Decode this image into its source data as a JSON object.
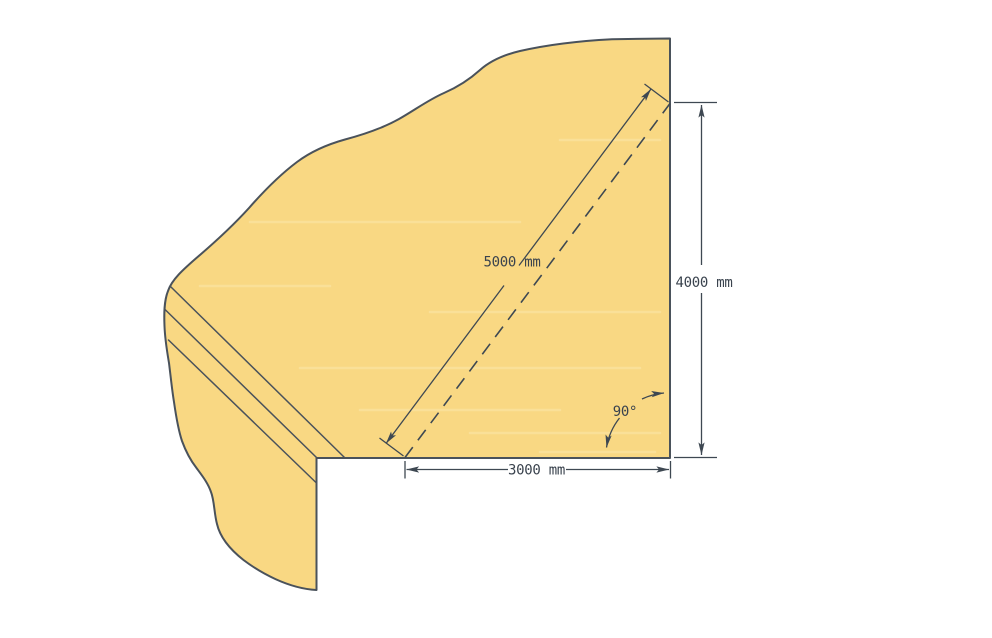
{
  "diagram": {
    "labels": {
      "diagonal_dim": "5000 mm",
      "vertical_dim": "4000 mm",
      "horizontal_dim": "3000 mm",
      "angle": "90°"
    },
    "colors": {
      "surface": "#F9D883",
      "surface_streak": "#FCE8A9",
      "outline": "#4A525B",
      "dimension": "#3E4852",
      "text": "#3A434E",
      "background": "#FFFFFF"
    }
  }
}
